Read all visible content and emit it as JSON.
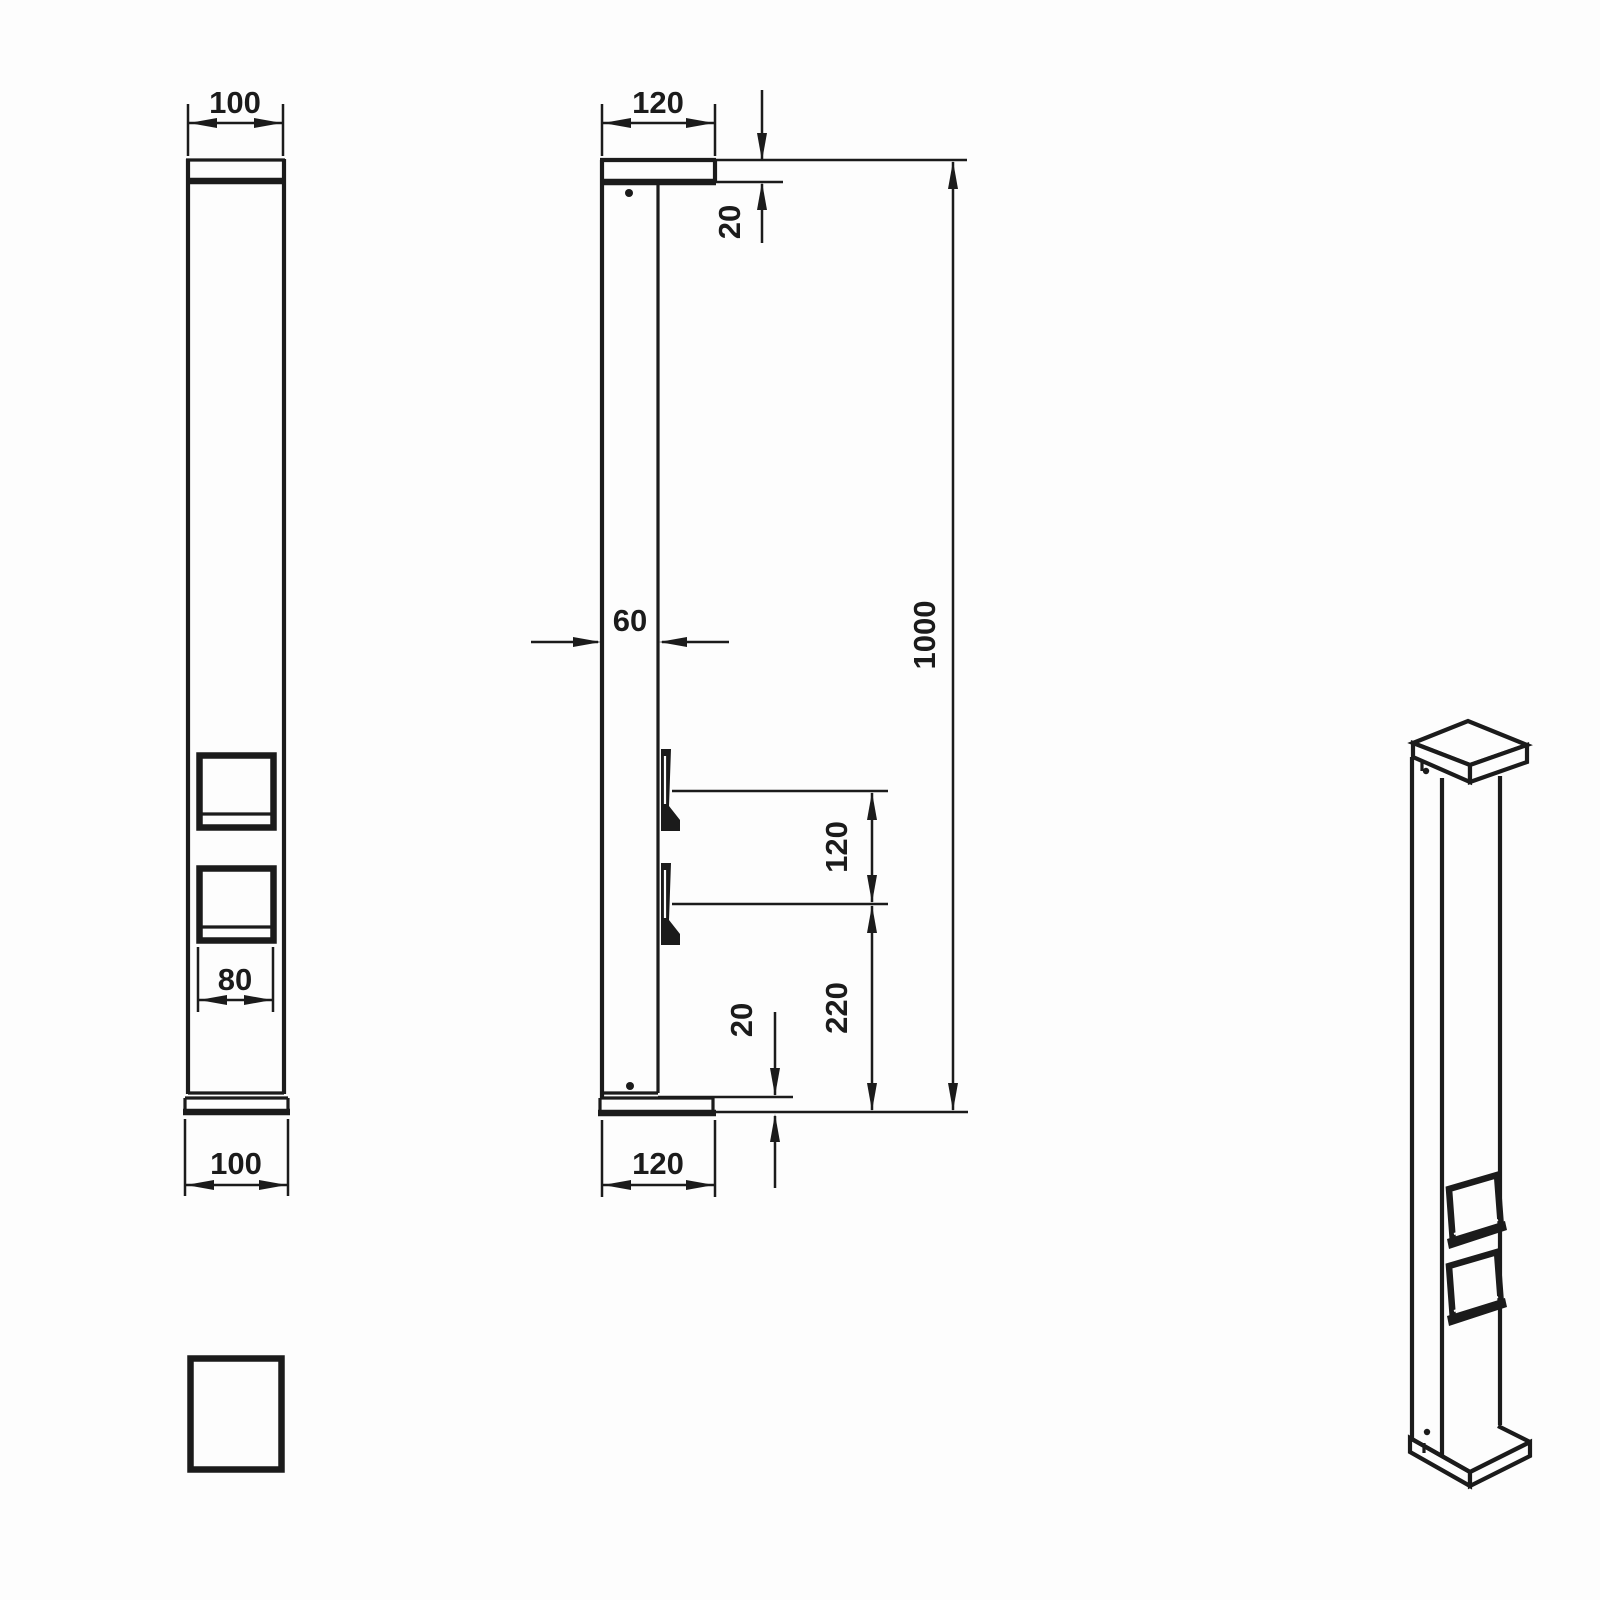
{
  "drawing": {
    "background": "#fdfdfd",
    "line_color": "#1b1b1b",
    "front_view": {
      "width_top": "100",
      "socket_width": "80",
      "width_bottom": "100"
    },
    "side_view": {
      "depth_top": "120",
      "cap_thickness": "20",
      "body_depth": "60",
      "overall_height": "1000",
      "socket_spacing": "120",
      "socket_to_base": "220",
      "base_thickness": "20",
      "depth_bottom": "120"
    }
  }
}
